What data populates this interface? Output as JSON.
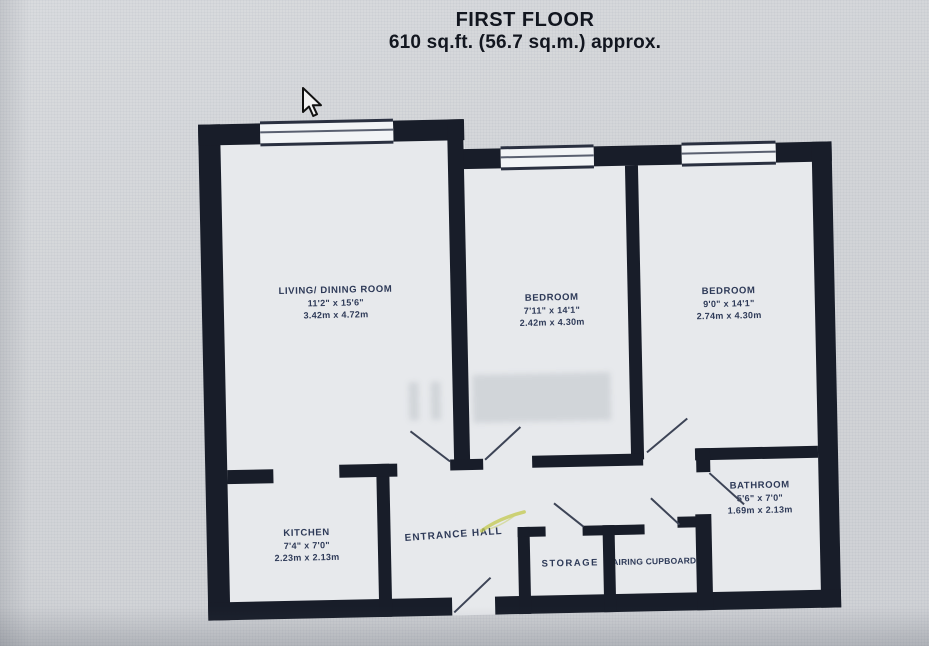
{
  "header": {
    "title": "FIRST FLOOR",
    "area": "610 sq.ft. (56.7 sq.m.) approx."
  },
  "rooms": [
    {
      "id": "living-dining",
      "name": "LIVING/ DINING ROOM",
      "imperial": "11'2\" x 15'6\"",
      "metric": "3.42m x 4.72m"
    },
    {
      "id": "bedroom-1",
      "name": "BEDROOM",
      "imperial": "7'11\" x 14'1\"",
      "metric": "2.42m x 4.30m"
    },
    {
      "id": "bedroom-2",
      "name": "BEDROOM",
      "imperial": "9'0\" x 14'1\"",
      "metric": "2.74m x 4.30m"
    },
    {
      "id": "kitchen",
      "name": "KITCHEN",
      "imperial": "7'4\" x 7'0\"",
      "metric": "2.23m x 2.13m"
    },
    {
      "id": "bathroom",
      "name": "BATHROOM",
      "imperial": "5'6\" x 7'0\"",
      "metric": "1.69m x 2.13m"
    },
    {
      "id": "entrance-hall",
      "name": "ENTRANCE HALL"
    },
    {
      "id": "storage",
      "name": "STORAGE"
    },
    {
      "id": "airing-cupboard",
      "name": "AIRING CUPBOARD"
    }
  ],
  "cursor": {
    "type": "arrow-pointer",
    "x": 302,
    "y": 89
  },
  "colors": {
    "wall": "#181d29",
    "label_text": "#2e3a58",
    "title_text": "#12161f",
    "paper": "#e7e9ec",
    "photo_background": "#d4d6d9",
    "annotation_mark": "#c3c94e"
  }
}
